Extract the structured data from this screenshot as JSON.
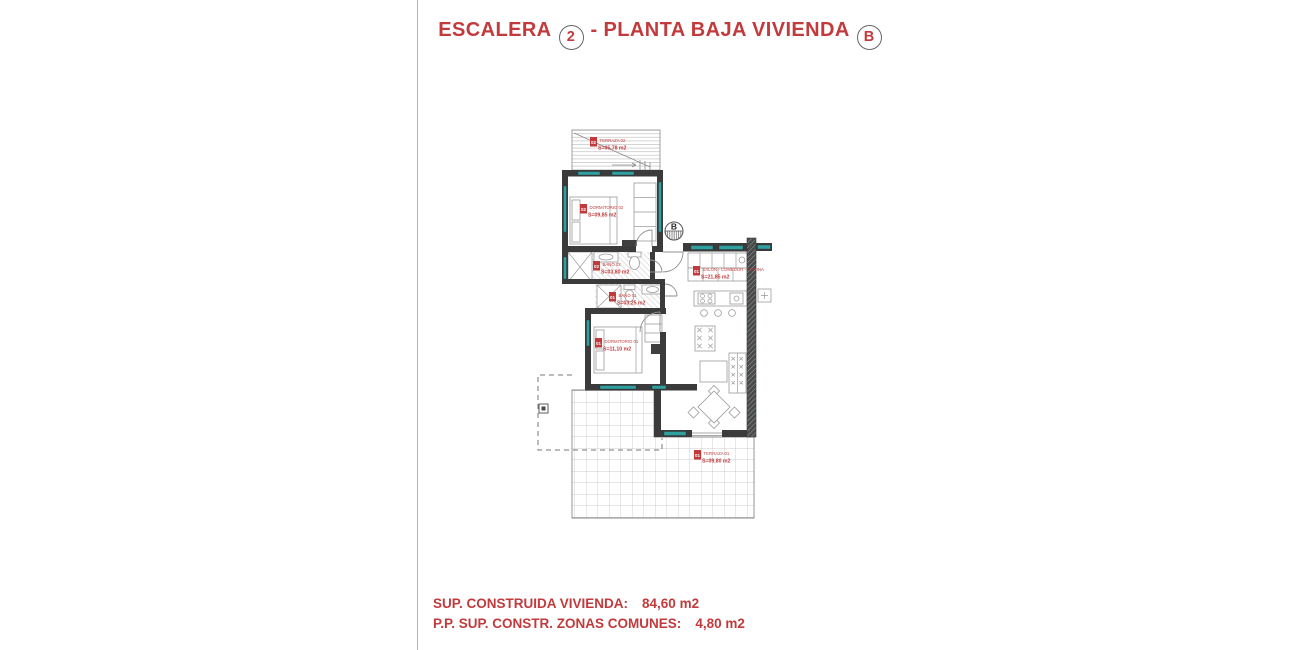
{
  "title": {
    "word1": "ESCALERA",
    "num": "2",
    "word2": "- PLANTA BAJA VIVIENDA",
    "letter": "B"
  },
  "plan": {
    "marker_letter": "B",
    "rooms": {
      "terraza2": {
        "num": "02",
        "name": "TERRAZA 02",
        "area": "S=05,78 m2"
      },
      "dormitorio2": {
        "num": "02",
        "name": "DORMITORIO 02",
        "area": "S=09,85 m2"
      },
      "bano2": {
        "num": "02",
        "name": "BAÑO 02",
        "area": "S=03,80 m2"
      },
      "bano1": {
        "num": "01",
        "name": "BAÑO 01",
        "area": "S=03,25 m2"
      },
      "dormitorio1": {
        "num": "01",
        "name": "DORMITORIO 01",
        "area": "S=11,10 m2"
      },
      "salon": {
        "num": "01",
        "name": "SALON - COMEDOR - COCINA",
        "area": "S=21,85 m2"
      },
      "terraza1": {
        "num": "01",
        "name": "TERRAZA 01",
        "area": "S=09,80 m2"
      }
    },
    "colors": {
      "red": "#c23a3c",
      "wall": "#3b3b3b",
      "teal": "#2f9fa0"
    }
  },
  "footer": {
    "line1_label": "SUP. CONSTRUIDA VIVIENDA:",
    "line1_value": "84,60 m2",
    "line2_label": "P.P. SUP. CONSTR. ZONAS COMUNES:",
    "line2_value": "4,80 m2"
  }
}
